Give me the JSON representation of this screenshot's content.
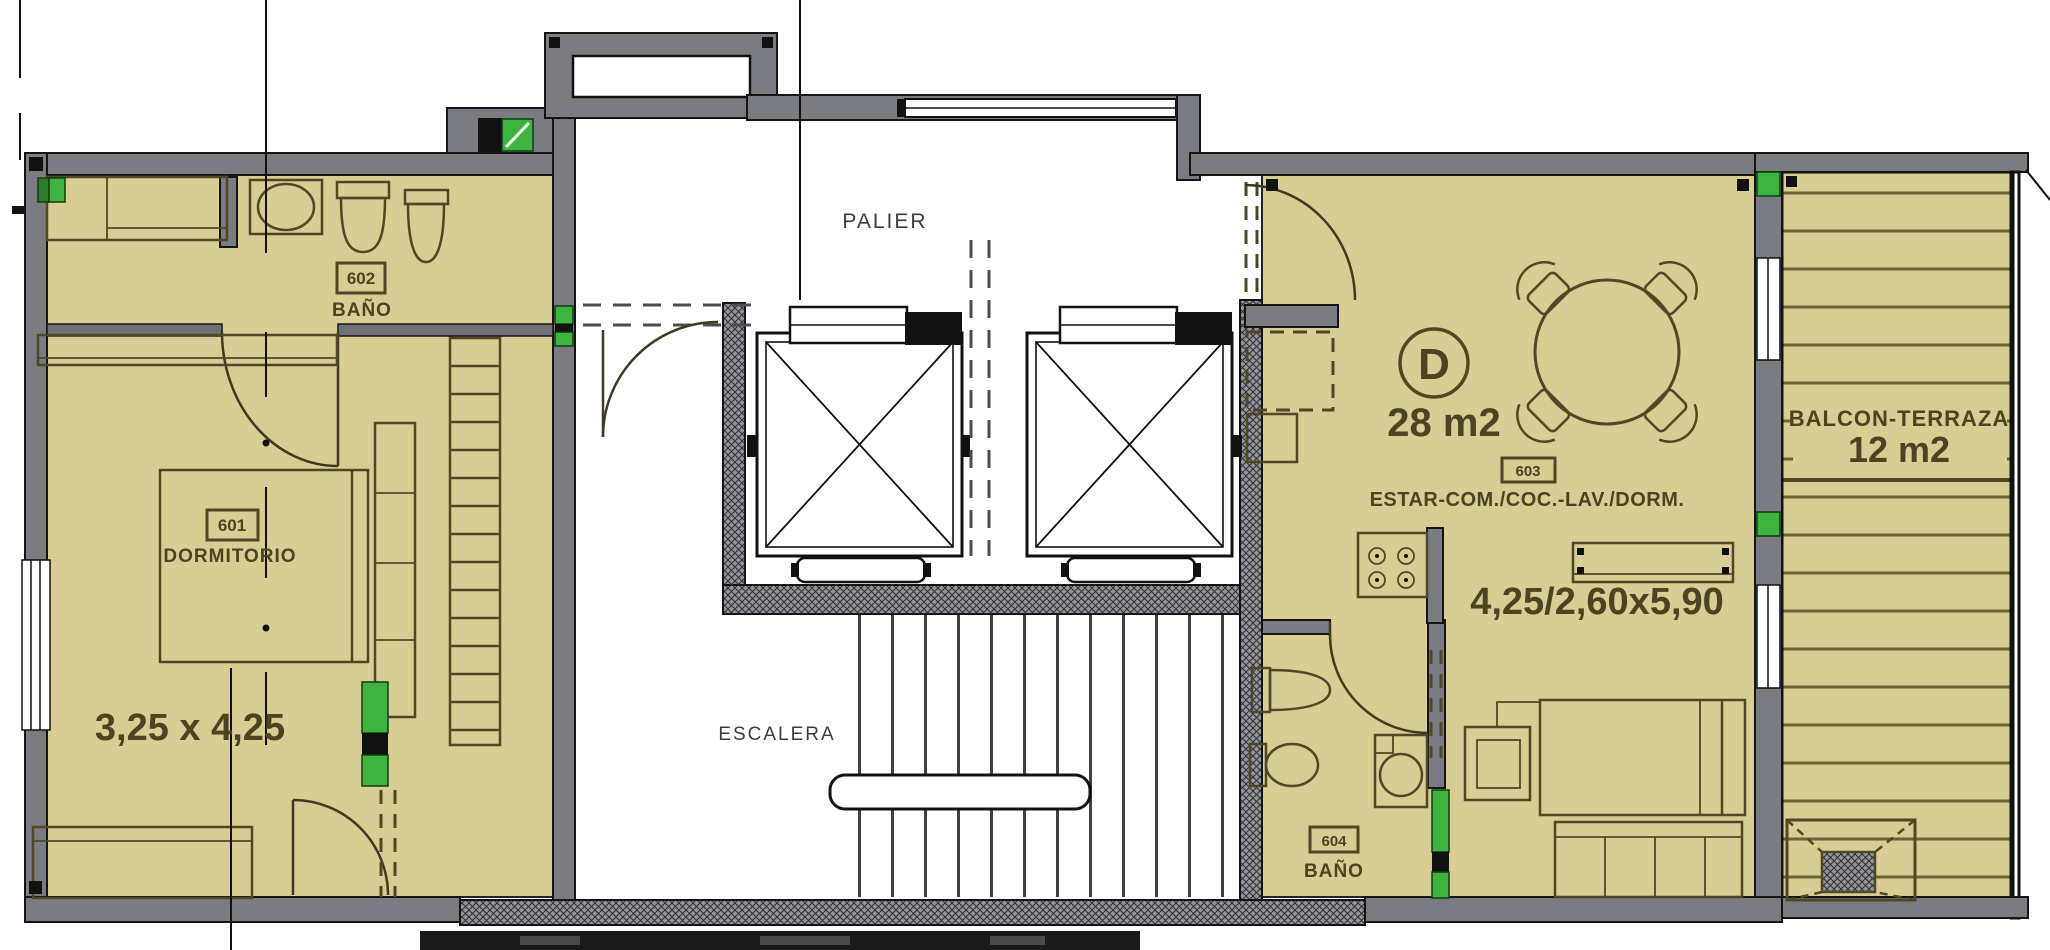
{
  "plan": {
    "rooms": {
      "palier": {
        "label": "PALIER"
      },
      "escalera": {
        "label": "ESCALERA"
      },
      "dormitorio_601": {
        "code": "601",
        "label": "DORMITORIO",
        "dimensions": "3,25 x 4,25"
      },
      "bano_602": {
        "code": "602",
        "label": "BAÑO"
      },
      "estar_603": {
        "unit": "D",
        "area": "28 m2",
        "code": "603",
        "label": "ESTAR-COM./COC.-LAV./DORM.",
        "dimensions": "4,25/2,60x5,90"
      },
      "bano_604": {
        "code": "604",
        "label": "BAÑO"
      },
      "balcon_terraza": {
        "label": "BALCON-TERRAZA",
        "area": "12 m2"
      }
    },
    "colors": {
      "floor": "#d6ce93",
      "wall": "#7b7b82",
      "hatched_wall": "#94949b",
      "drawing_line": "#4f4827",
      "marker_green": "#3fb33f",
      "plan_text": "#4a4423"
    }
  }
}
